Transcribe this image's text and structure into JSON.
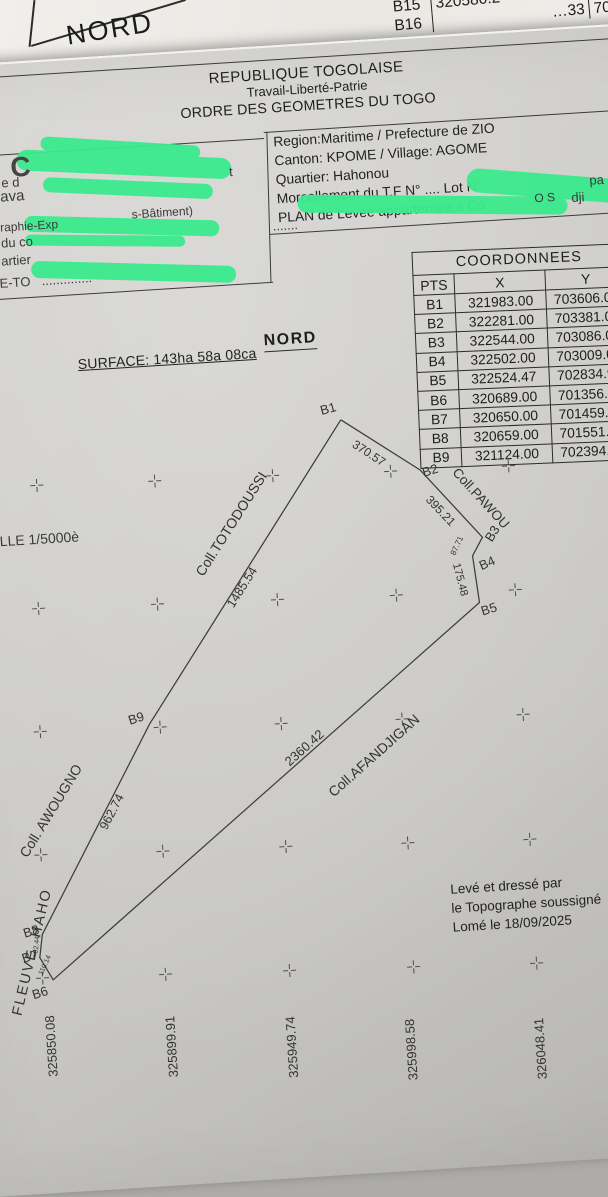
{
  "underlay": {
    "nord": "NORD",
    "mini_table": {
      "rows": [
        {
          "pt": "B15",
          "x": "320580.2",
          "y": "70195"
        },
        {
          "pt": "B16",
          "x": "…33",
          "y": "7019"
        }
      ]
    }
  },
  "header": {
    "line1": "REPUBLIQUE TOGOLAISE",
    "line2": "Travail-Liberté-Patrie",
    "line3": "ORDRE DES GEOMETRES DU TOGO"
  },
  "info_box": {
    "lines": [
      "Region:Maritime / Prefecture de ZIO",
      "Canton: KPOME / Village: AGOME",
      "Quartier: Hahonou",
      "Morcellement du T.F N° .... Lot N°",
      "PLAN de Levée appartenant à Co"
    ]
  },
  "coordinates_table": {
    "title": "COORDONNEES",
    "columns": [
      "PTS",
      "X",
      "Y"
    ],
    "rows": [
      [
        "B1",
        "321983.00",
        "703606.00"
      ],
      [
        "B2",
        "322281.00",
        "703381.00"
      ],
      [
        "B3",
        "322544.00",
        "703086.00"
      ],
      [
        "B4",
        "322502.00",
        "703009.00"
      ],
      [
        "B5",
        "322524.47",
        "702834.96"
      ],
      [
        "B6",
        "320689.00",
        "701356.00"
      ],
      [
        "B7",
        "320650.00",
        "701459.00"
      ],
      [
        "B8",
        "320659.00",
        "701551.00"
      ],
      [
        "B9",
        "321124.00",
        "702394.00"
      ]
    ]
  },
  "labels": {
    "north": "NORD",
    "surface": "SURFACE: 143ha 58a 08ca",
    "credit1": "Levé et dressé par",
    "credit2": "le Topographe soussigné",
    "credit3": "Lomé le 18/09/2025"
  },
  "fragments": {
    "items": [
      {
        "t": "C",
        "x": 94,
        "y": 88,
        "s": 28,
        "cls": "big",
        "n": "redacted-fragment"
      },
      {
        "t": "t",
        "x": 312,
        "y": 114,
        "s": 13,
        "n": "redacted-fragment"
      },
      {
        "t": "e d",
        "x": 84,
        "y": 111,
        "s": 13,
        "n": "redacted-fragment"
      },
      {
        "t": "ava",
        "x": 82,
        "y": 124,
        "s": 15,
        "n": "redacted-fragment"
      },
      {
        "t": "raphie-Exp",
        "x": 80,
        "y": 156,
        "s": 12,
        "n": "redacted-fragment"
      },
      {
        "t": "s-Bâtiment)",
        "x": 212,
        "y": 151,
        "s": 12,
        "n": "redacted-fragment"
      },
      {
        "t": "du co",
        "x": 80,
        "y": 171,
        "s": 13,
        "n": "redacted-fragment"
      },
      {
        "t": "artier",
        "x": 79,
        "y": 189,
        "s": 13,
        "n": "redacted-fragment"
      },
      {
        "t": "E-TO",
        "x": 76,
        "y": 211,
        "s": 13,
        "n": "redacted-fragment"
      },
      {
        "t": "..............",
        "x": 118,
        "y": 211,
        "s": 13,
        "n": "redacted-fragment"
      },
      {
        "t": "pa",
        "x": 671,
        "y": 145,
        "s": 13,
        "n": "redacted-fragment"
      },
      {
        "t": "O S",
        "x": 615,
        "y": 160,
        "s": 12,
        "n": "redacted-fragment"
      },
      {
        "t": "dji",
        "x": 652,
        "y": 161,
        "s": 13,
        "n": "redacted-fragment"
      },
      {
        "t": ".......",
        "x": 352,
        "y": 171,
        "s": 13,
        "n": "redacted-fragment"
      },
      {
        "t": "LLE 1/5000è",
        "x": 60,
        "y": 468,
        "s": 14,
        "n": "scale-label"
      }
    ]
  },
  "plot": {
    "outline": [
      [
        408,
        376
      ],
      [
        484,
        431
      ],
      [
        542,
        502
      ],
      [
        531,
        520
      ],
      [
        535,
        567
      ],
      [
        86,
        917
      ],
      [
        74,
        894
      ],
      [
        78,
        871
      ],
      [
        198,
        668
      ],
      [
        408,
        376
      ]
    ],
    "texts": [
      {
        "t": "B1",
        "x": 396,
        "y": 364,
        "r": -12,
        "s": 13,
        "n": "vertex-label"
      },
      {
        "t": "B2",
        "x": 494,
        "y": 432,
        "r": -14,
        "s": 13,
        "n": "vertex-label"
      },
      {
        "t": "B3",
        "x": 552,
        "y": 499,
        "r": -55,
        "s": 13,
        "n": "vertex-label"
      },
      {
        "t": "B4",
        "x": 545,
        "y": 528,
        "r": -20,
        "s": 13,
        "n": "vertex-label"
      },
      {
        "t": "B5",
        "x": 544,
        "y": 574,
        "r": -14,
        "s": 13,
        "n": "vertex-label"
      },
      {
        "t": "B6",
        "x": 72,
        "y": 929,
        "r": -14,
        "s": 13,
        "n": "vertex-label"
      },
      {
        "t": "B7",
        "x": 64,
        "y": 892,
        "r": -14,
        "s": 13,
        "n": "vertex-label"
      },
      {
        "t": "B8",
        "x": 67,
        "y": 867,
        "r": -14,
        "s": 13,
        "n": "vertex-label"
      },
      {
        "t": "B9",
        "x": 185,
        "y": 661,
        "r": -14,
        "s": 13,
        "n": "vertex-label"
      },
      {
        "t": "370.57",
        "x": 434,
        "y": 411,
        "r": 37,
        "s": 12,
        "n": "edge-length"
      },
      {
        "t": "395.21",
        "x": 502,
        "y": 473,
        "r": 50,
        "s": 12,
        "n": "edge-length"
      },
      {
        "t": "87.71",
        "x": 516,
        "y": 509,
        "r": -62,
        "s": 8,
        "n": "edge-length"
      },
      {
        "t": "175.48",
        "x": 517,
        "y": 543,
        "r": 79,
        "s": 11,
        "n": "edge-length"
      },
      {
        "t": "2360.42",
        "x": 351,
        "y": 701,
        "r": -38,
        "s": 13,
        "n": "edge-length"
      },
      {
        "t": "1485.54",
        "x": 299,
        "y": 537,
        "r": -54,
        "s": 12.5,
        "n": "edge-length"
      },
      {
        "t": "962.74",
        "x": 155,
        "y": 753,
        "r": -59,
        "s": 12.5,
        "n": "edge-length"
      },
      {
        "t": "110.14",
        "x": 79,
        "y": 902,
        "r": -62,
        "s": 7,
        "n": "edge-length"
      },
      {
        "t": "92.44",
        "x": 72,
        "y": 881,
        "r": -80,
        "s": 7,
        "n": "edge-length"
      },
      {
        "t": "Coll.PAWOU",
        "x": 543,
        "y": 463,
        "r": 51,
        "s": 13.5,
        "n": "owner-label"
      },
      {
        "t": "Coll.TOTODOUSSI",
        "x": 292,
        "y": 473,
        "r": -54,
        "s": 14,
        "n": "owner-label"
      },
      {
        "t": "Coll.AFANDJIGAN",
        "x": 420,
        "y": 713,
        "r": -38,
        "s": 14,
        "n": "owner-label"
      },
      {
        "t": "Coll. AWOUGNO",
        "x": 94,
        "y": 748,
        "r": -55,
        "s": 14,
        "n": "owner-label"
      },
      {
        "t": "FLEUVE  HAHO",
        "x": 67,
        "y": 888,
        "r": -73,
        "s": 14.5,
        "ls": 2,
        "n": "river-label"
      },
      {
        "t": "325850.08",
        "x": 80,
        "y": 983,
        "r": -90,
        "s": 13,
        "n": "axis-label"
      },
      {
        "t": "325899.91",
        "x": 200,
        "y": 991,
        "r": -90,
        "s": 13,
        "n": "axis-label"
      },
      {
        "t": "325949.74",
        "x": 320,
        "y": 999,
        "r": -90,
        "s": 13,
        "n": "axis-label"
      },
      {
        "t": "325998.58",
        "x": 439,
        "y": 1009,
        "r": -90,
        "s": 13,
        "n": "axis-label"
      },
      {
        "t": "326048.41",
        "x": 568,
        "y": 1016,
        "r": -90,
        "s": 13,
        "n": "axis-label"
      }
    ],
    "crosses": [
      [
        100,
        422
      ],
      [
        218,
        425
      ],
      [
        336,
        427
      ],
      [
        454,
        430
      ],
      [
        572,
        432
      ],
      [
        94,
        545
      ],
      [
        213,
        548
      ],
      [
        333,
        551
      ],
      [
        452,
        554
      ],
      [
        571,
        556
      ],
      [
        88,
        668
      ],
      [
        208,
        671
      ],
      [
        329,
        675
      ],
      [
        450,
        678
      ],
      [
        571,
        681
      ],
      [
        81,
        791
      ],
      [
        203,
        795
      ],
      [
        326,
        798
      ],
      [
        448,
        802
      ],
      [
        570,
        806
      ],
      [
        75,
        914
      ],
      [
        198,
        918
      ],
      [
        322,
        922
      ],
      [
        446,
        926
      ],
      [
        569,
        930
      ]
    ]
  }
}
